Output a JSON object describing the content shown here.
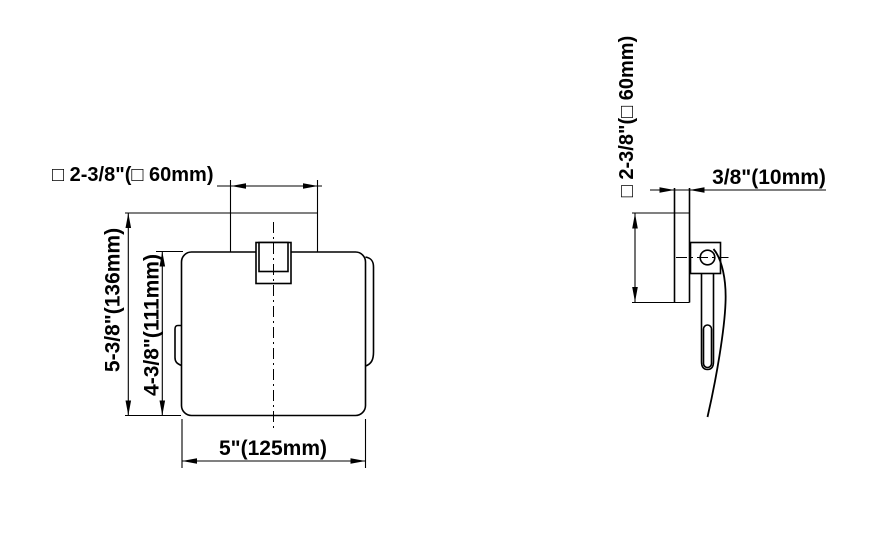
{
  "front_view": {
    "mount_width_label": "□ 2-3/8\"(□ 60mm)",
    "overall_height_label": "5-3/8\"(136mm)",
    "holder_height_label": "4-3/8\"(111mm)",
    "holder_width_label": "5\"(125mm)"
  },
  "side_view": {
    "mount_height_label": "□ 2-3/8\"(□ 60mm)",
    "wall_plate_depth_label": "3/8\"(10mm)"
  },
  "colors": {
    "line": "#000000",
    "background": "#ffffff"
  }
}
